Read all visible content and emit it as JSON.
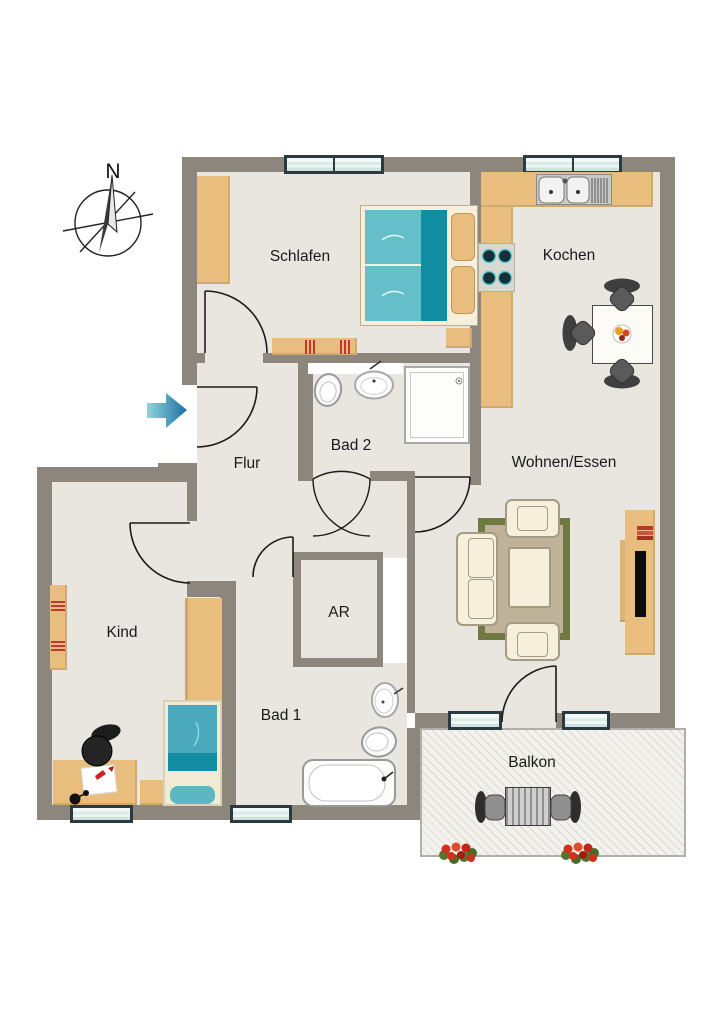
{
  "compass": {
    "north_label": "N"
  },
  "rooms": {
    "schlafen": {
      "label": "Schlafen"
    },
    "kochen": {
      "label": "Kochen"
    },
    "flur": {
      "label": "Flur"
    },
    "bad2": {
      "label": "Bad 2"
    },
    "wohnen_essen": {
      "label": "Wohnen/Essen"
    },
    "kind": {
      "label": "Kind"
    },
    "ar": {
      "label": "AR"
    },
    "bad1": {
      "label": "Bad 1"
    },
    "balkon": {
      "label": "Balkon"
    }
  },
  "icons": {
    "entrance": "entrance-arrow-icon",
    "compass": "compass-rose-icon"
  },
  "colors": {
    "wall": "#8d867c",
    "floor": "#e9e6df",
    "wood": "#e8bd7d",
    "wood_dark": "#c2945a",
    "teal": "#45aebf",
    "teal_dark": "#128ea4",
    "teal_light": "#64bfcb",
    "cream": "#f5efdc",
    "cream_border": "#a39c85",
    "win": "#d9ebe7",
    "win_border": "#2a3a40",
    "rug": "#6e7a41",
    "rug_in": "#bfb298",
    "chair": "#4a4a4a",
    "red": "#c43226",
    "hatch": "#dcd9d2",
    "arrow_light": "#8fd4dc",
    "arrow_dark": "#1d6fa3"
  }
}
